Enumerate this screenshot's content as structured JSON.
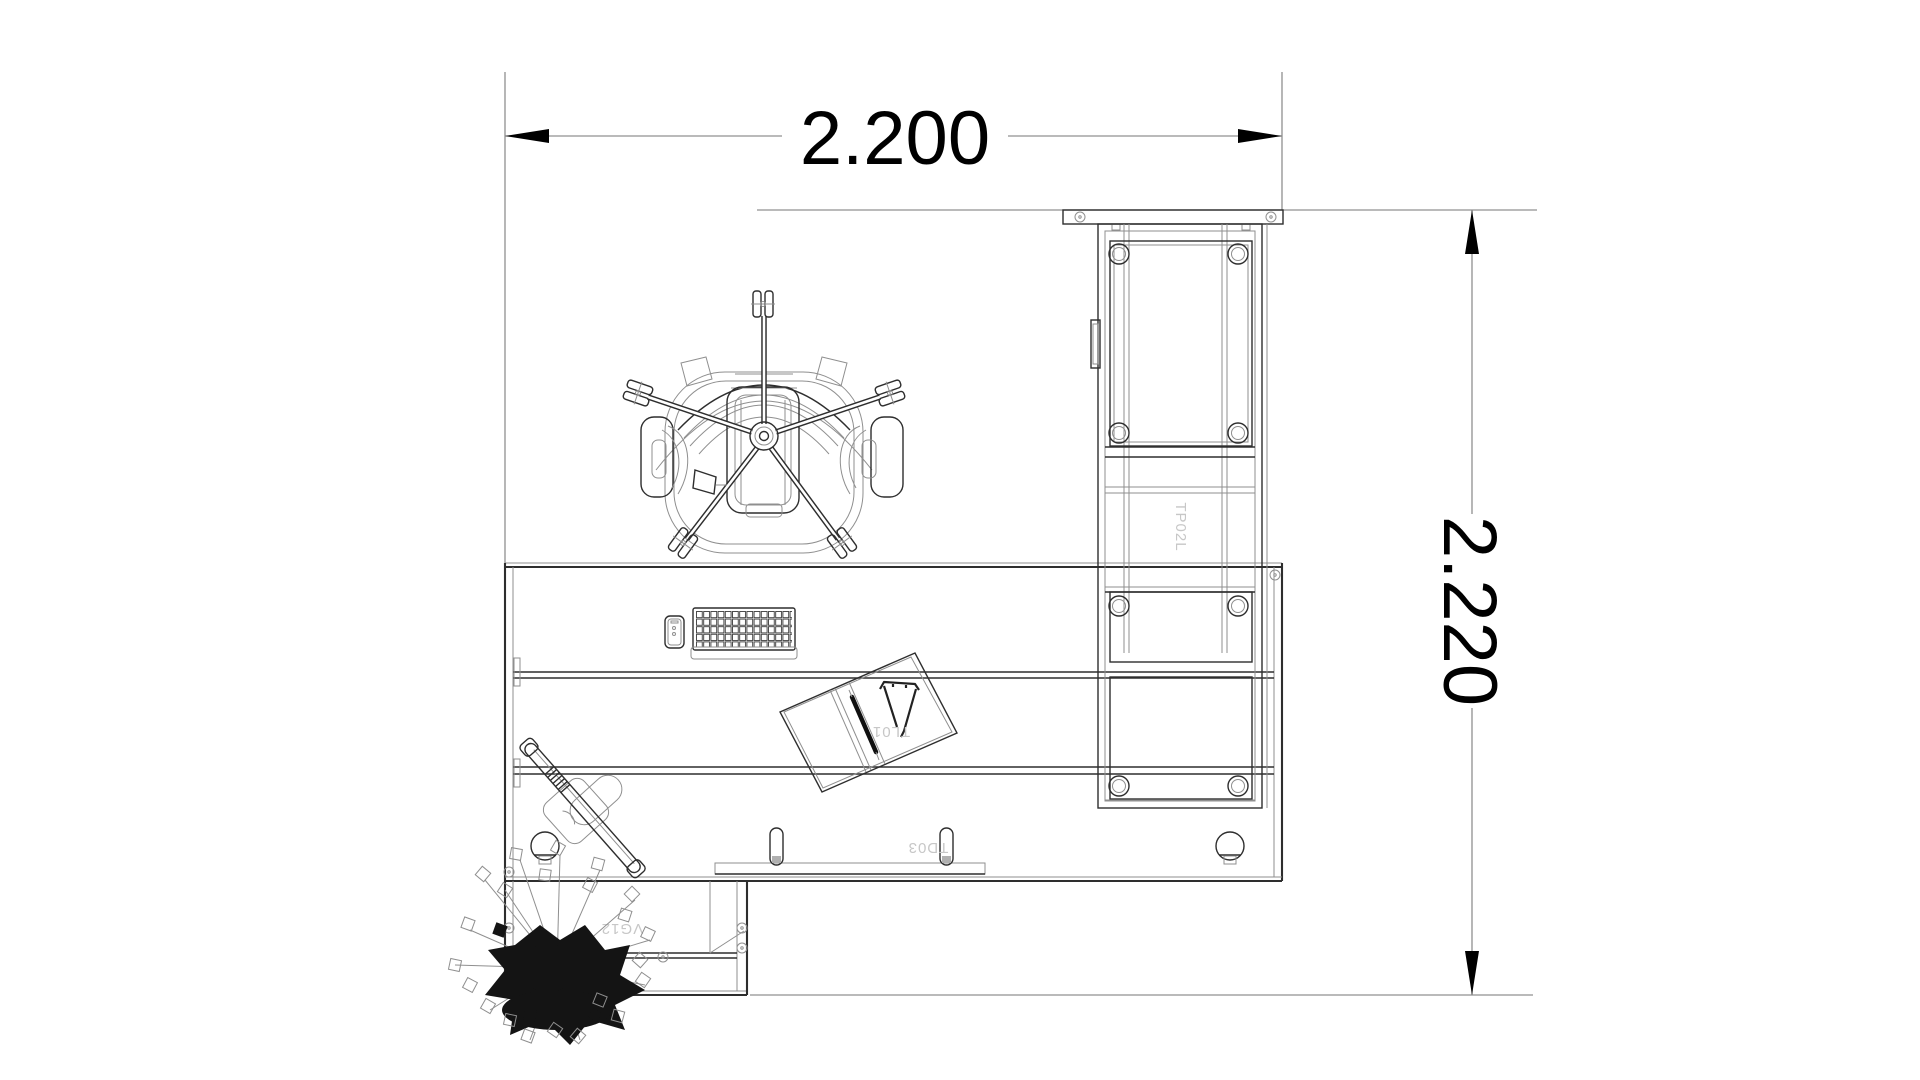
{
  "drawing": {
    "background": "#ffffff",
    "dimensions": {
      "width": {
        "value": "2.200"
      },
      "depth": {
        "value": "2.220"
      }
    },
    "labels": {
      "cabinet_code": "TP02L",
      "folder_code": "TL01",
      "desk_code": "TD03",
      "return_code": "VG12"
    },
    "colors": {
      "line": "#2e2e2e",
      "thin_line": "#8f8f8f",
      "dimension_line": "#909090",
      "dimension_text": "#000000",
      "arrow_fill": "#000000",
      "code_text": "#c7c7c7"
    }
  }
}
